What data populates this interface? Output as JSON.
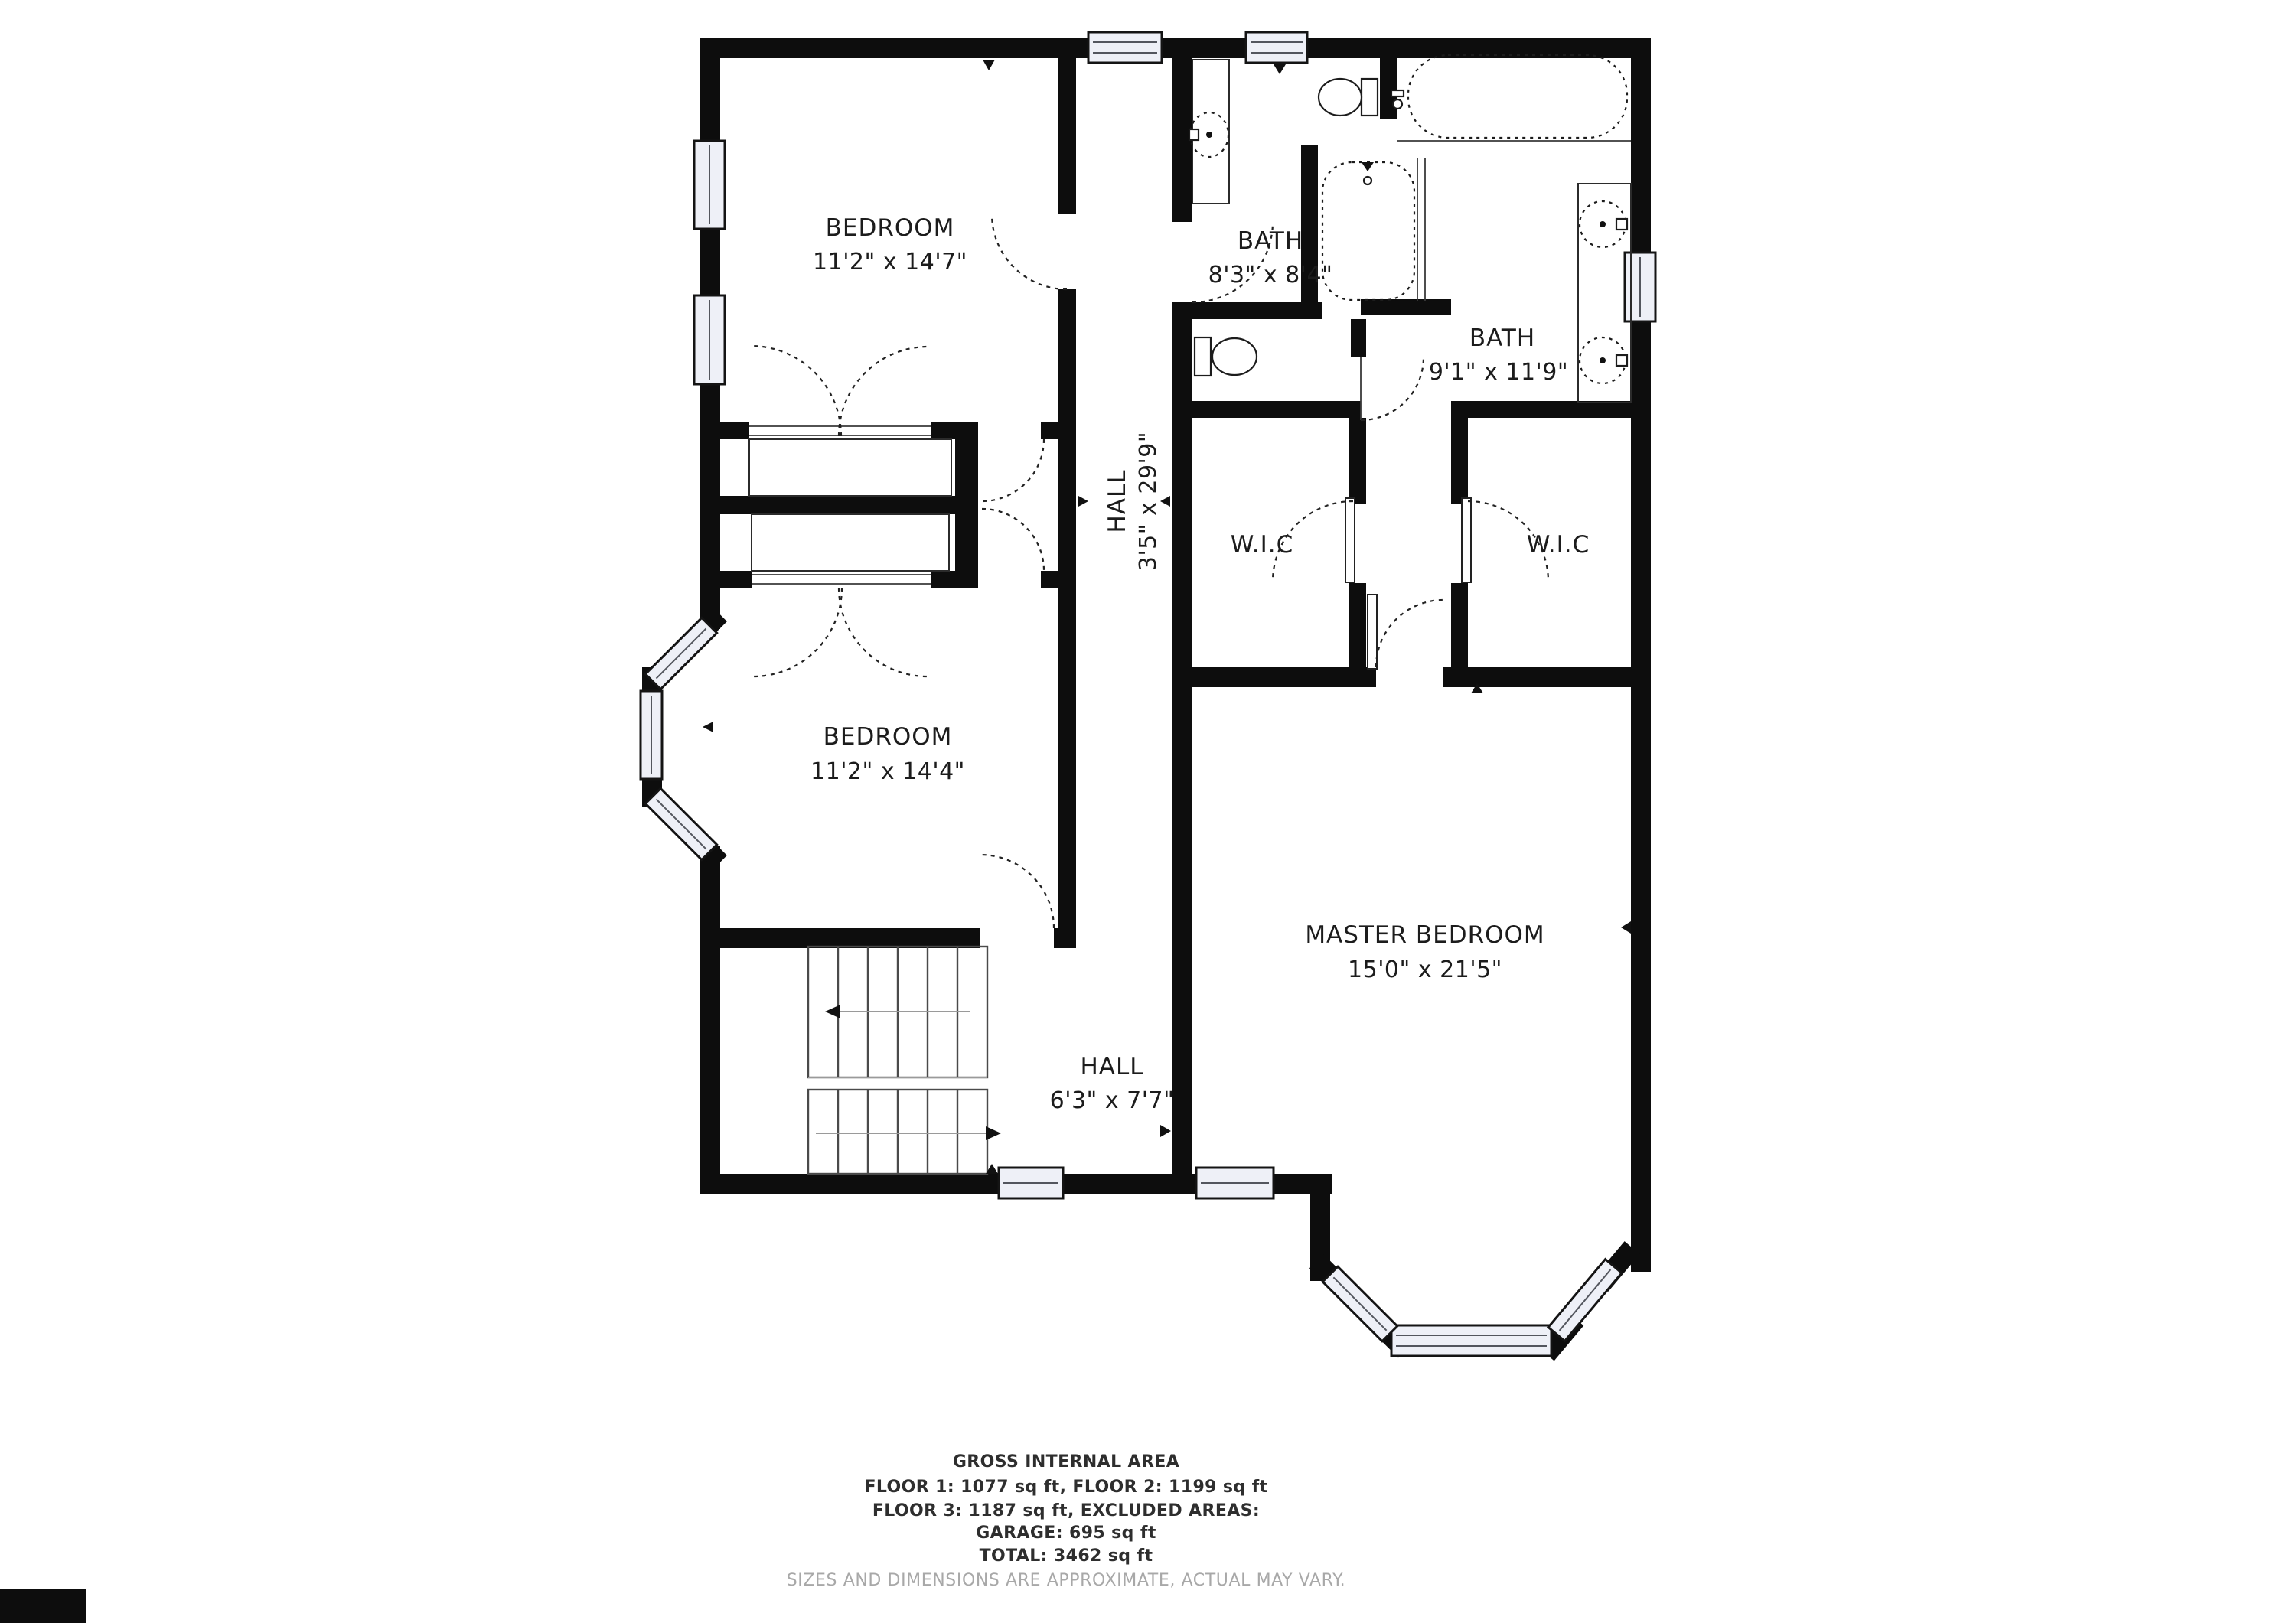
{
  "meta": {
    "title": "Second floor plan",
    "wall_color": "#0d0d0d",
    "background_color": "#ffffff",
    "window_fill_color": "#eef0f7",
    "disclaimer_color": "#a8a8a8"
  },
  "rooms": {
    "bedroom_top": {
      "name": "BEDROOM",
      "dims": "11'2\" x 14'7\""
    },
    "bath_top": {
      "name": "BATH",
      "dims": "8'3\" x 8'4\""
    },
    "bath_master": {
      "name": "BATH",
      "dims": "9'1\" x 11'9\""
    },
    "hall_upper": {
      "name": "HALL",
      "dims": "3'5\" x 29'9\""
    },
    "wic_left": {
      "name": "W.I.C"
    },
    "wic_right": {
      "name": "W.I.C"
    },
    "bedroom_bottom": {
      "name": "BEDROOM",
      "dims": "11'2\" x 14'4\""
    },
    "master_bedroom": {
      "name": "MASTER BEDROOM",
      "dims": "15'0\" x 21'5\""
    },
    "hall_lower": {
      "name": "HALL",
      "dims": "6'3\" x 7'7\""
    }
  },
  "footer": {
    "line1": "GROSS INTERNAL AREA",
    "line2": "FLOOR 1: 1077 sq ft, FLOOR 2: 1199 sq ft",
    "line3": "FLOOR 3: 1187 sq ft, EXCLUDED AREAS:",
    "line4": "GARAGE: 695 sq ft",
    "line5": "TOTAL: 3462 sq ft",
    "disclaimer": "SIZES AND DIMENSIONS ARE APPROXIMATE, ACTUAL MAY VARY."
  }
}
